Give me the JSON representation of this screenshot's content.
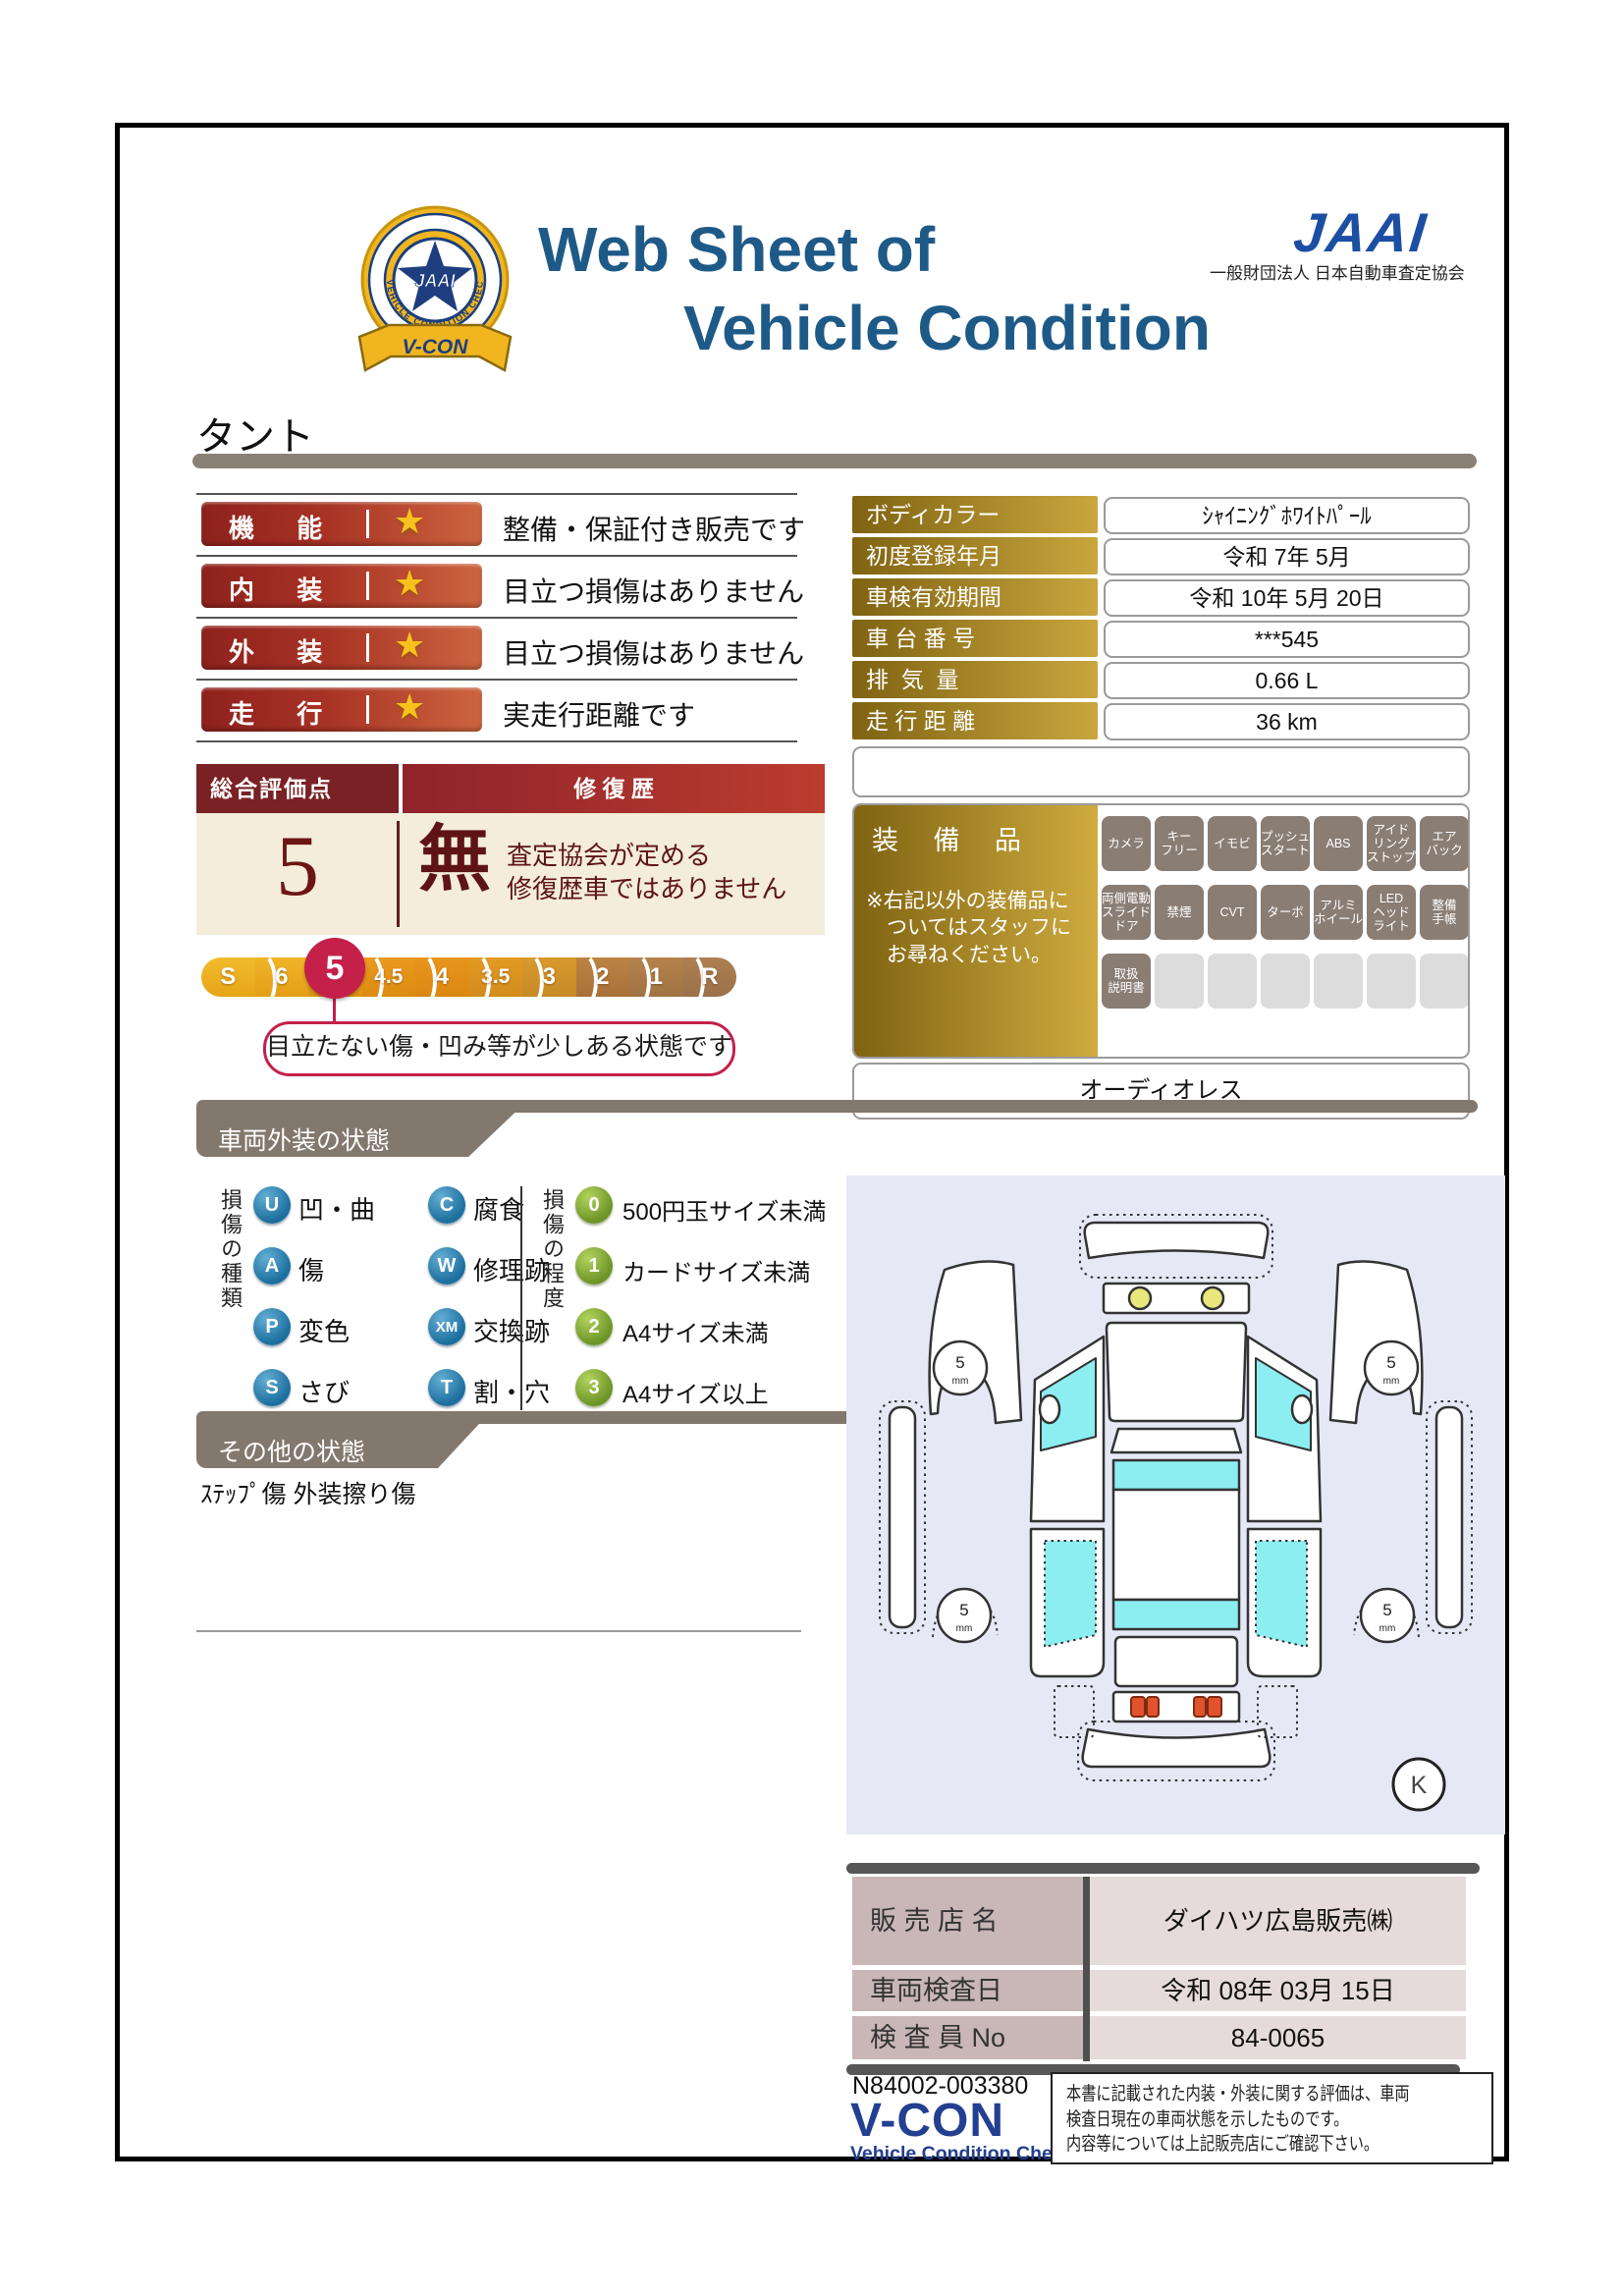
{
  "colors": {
    "title_blue": "#1e5a87",
    "jaai_blue": "#1c4fa3",
    "rating_bar_red": "#8e211d",
    "overall_maroon": "#7a2125",
    "overall_cream": "#f3edda",
    "selected_crimson": "#c4204a",
    "gold_dark": "#7f6311",
    "gold_light": "#cfab3f",
    "badge_gray": "#8a7d74",
    "banner_gray": "#83786d",
    "dealer_label_pink": "#c9b6b6",
    "dealer_value_pink": "#e6dbdb",
    "diagram_bg": "#e6e8f5",
    "window_cyan": "#8deef2",
    "type_circle_blue": "#1c6e9e",
    "degree_circle_green": "#6d9427"
  },
  "header": {
    "title_line1": "Web Sheet of",
    "title_line2": "Vehicle Condition",
    "jaai_wordmark": "JAAI",
    "jaai_org": "一般財団法人 日本自動車査定協会",
    "badge_ribbon": "V-CON",
    "badge_center": "JAAI",
    "badge_ring": "VEHICLE CONDITION CHECK SYSTEM"
  },
  "vehicle_name": "タント",
  "ratings": [
    {
      "label": "機 能",
      "desc": "整備・保証付き販売です"
    },
    {
      "label": "内 装",
      "desc": "目立つ損傷はありません"
    },
    {
      "label": "外 装",
      "desc": "目立つ損傷はありません"
    },
    {
      "label": "走 行",
      "desc": "実走行距離です"
    }
  ],
  "overall": {
    "header_left": "総合評価点",
    "header_right": "修 復 歴",
    "score": "5",
    "repair_mark": "無",
    "repair_desc": "査定協会が定める\n修復歴車ではありません",
    "scale": [
      "S",
      "6",
      "5",
      "4.5",
      "4",
      "3.5",
      "3",
      "2",
      "1",
      "R"
    ],
    "selected_value": "5",
    "callout": "目立たない傷・凹み等が少しある状態です"
  },
  "details": {
    "rows": [
      {
        "label": "ボディカラー",
        "value": "ｼｬｲﾆﾝｸﾞﾎﾜｲﾄﾊﾟｰﾙ"
      },
      {
        "label": "初度登録年月",
        "value": "令和 7年 5月"
      },
      {
        "label": "車検有効期間",
        "value": "令和 10年 5月 20日"
      },
      {
        "label": "車 台 番 号",
        "value": "***545"
      },
      {
        "label": "排  気  量",
        "value": "0.66 L"
      },
      {
        "label": "走 行 距 離",
        "value": "36 km"
      }
    ]
  },
  "equipment": {
    "title": "装 備 品",
    "note": "※右記以外の装備品に\n　ついてはスタッフに\n　お尋ねください。",
    "rows": [
      [
        "カメラ",
        "キー\nフリー",
        "イモビ",
        "プッシュ\nスタート",
        "ABS",
        "アイド\nリング\nストップ",
        "エア\nバック"
      ],
      [
        "両側電動\nスライド\nドア",
        "禁煙",
        "CVT",
        "ターボ",
        "アルミ\nホイール",
        "LED\nヘッド\nライト",
        "整備\n手帳"
      ],
      [
        "取扱\n説明書",
        "",
        "",
        "",
        "",
        "",
        ""
      ]
    ],
    "audio_note": "オーディオレス"
  },
  "exterior": {
    "section_title": "車両外装の状態",
    "type_label": "損傷の種類",
    "types": [
      {
        "code": "U",
        "label": "凹・曲"
      },
      {
        "code": "A",
        "label": "傷"
      },
      {
        "code": "P",
        "label": "変色"
      },
      {
        "code": "S",
        "label": "さび"
      },
      {
        "code": "C",
        "label": "腐食"
      },
      {
        "code": "W",
        "label": "修理跡"
      },
      {
        "code": "XM",
        "label": "交換跡"
      },
      {
        "code": "T",
        "label": "割・穴"
      }
    ],
    "degree_label": "損傷の程度",
    "degrees": [
      {
        "code": "0",
        "label": "500円玉サイズ未満"
      },
      {
        "code": "1",
        "label": "カードサイズ未満"
      },
      {
        "code": "2",
        "label": "A4サイズ未満"
      },
      {
        "code": "3",
        "label": "A4サイズ以上"
      }
    ]
  },
  "other": {
    "section_title": "その他の状態",
    "note": "ｽﾃｯﾌﾟ傷 外装擦り傷"
  },
  "diagram": {
    "tire_value": "5",
    "tire_unit": "mm",
    "marker": "K"
  },
  "dealer": {
    "rows": [
      {
        "label": "販 売 店 名",
        "value": "ダイハツ広島販売㈱"
      },
      {
        "label": "車両検査日",
        "value": "令和 08年 03月 15日"
      },
      {
        "label": "検 査 員 No",
        "value": "84-0065"
      }
    ]
  },
  "footer": {
    "doc_number": "N84002-003380",
    "logo": "V-CON",
    "logo_sub": "Vehicle Condition Check System",
    "disclaimer": "本書に記載された内装・外装に関する評価は、車両\n検査日現在の車両状態を示したものです。\n内容等については上記販売店にご確認下さい。"
  }
}
